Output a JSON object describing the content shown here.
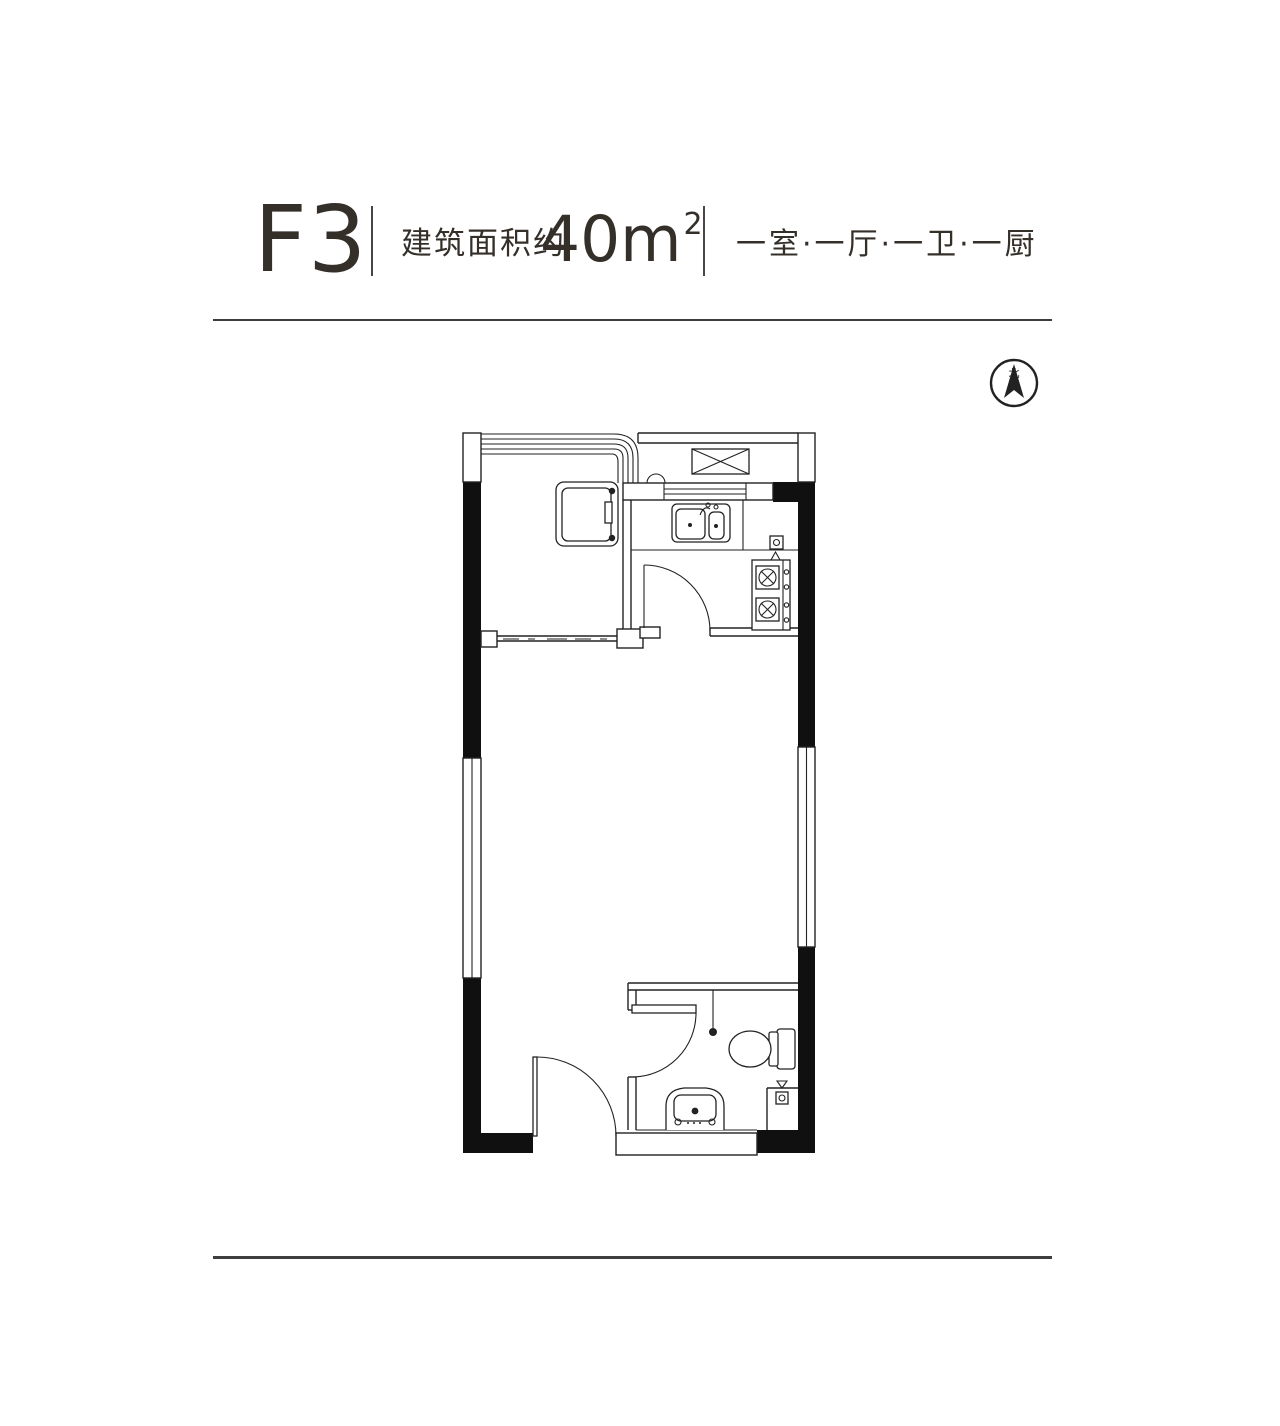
{
  "header": {
    "unit": "F3",
    "area_label": "建筑面积约",
    "area_value": "40m",
    "area_sup": "2",
    "layout": "一室·一厅·一卫·一厨"
  },
  "floor_plan": {
    "compass": {
      "label": "北"
    },
    "fixtures": [
      "north-compass",
      "balcony-glazing",
      "washing-machine",
      "flue-box",
      "kitchen-window",
      "kitchen-sink",
      "gas-meter",
      "gas-stove",
      "kitchen-door",
      "sliding-partition",
      "entry-door",
      "bathroom-door",
      "shower-point",
      "toilet",
      "wash-basin",
      "floor-drain"
    ]
  },
  "colors": {
    "text": "#352f2a",
    "line": "#222222",
    "wall_fill": "#101010",
    "rule": "#3e3e3e",
    "background": "#ffffff"
  }
}
